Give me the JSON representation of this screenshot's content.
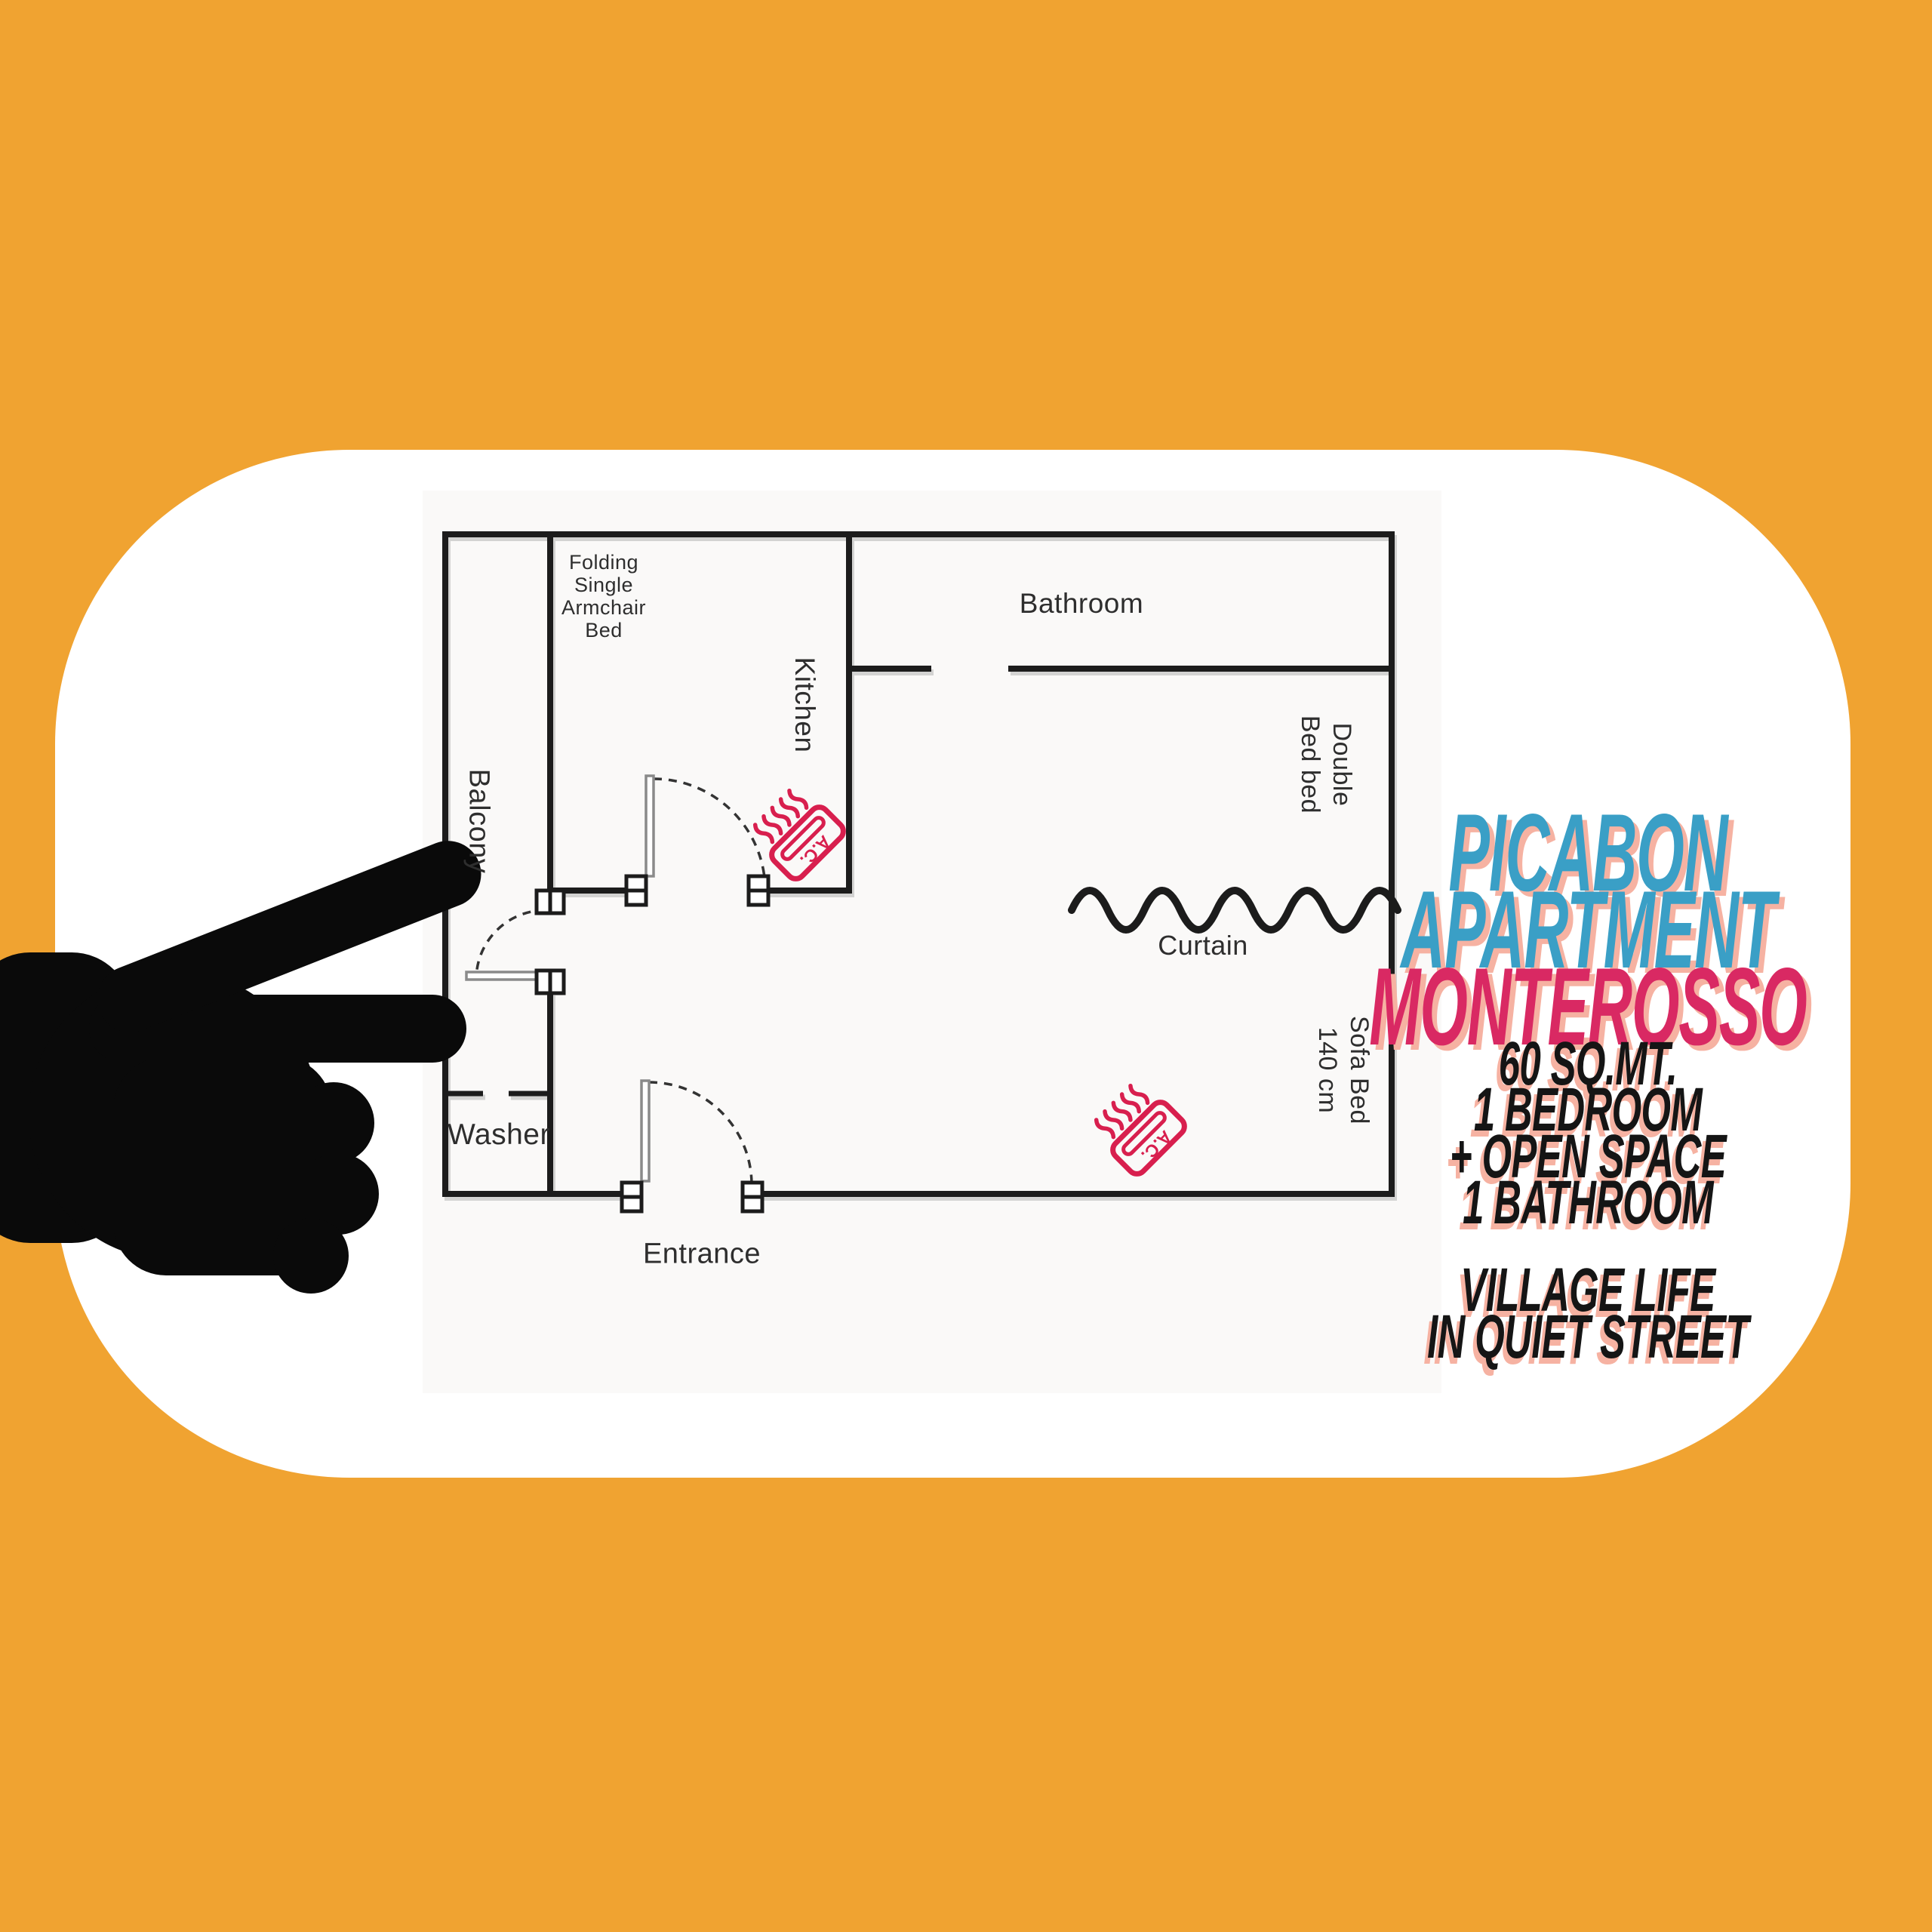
{
  "colors": {
    "background": "#F0A331",
    "card": "#FFFFFF",
    "wall": "#1C1C1C",
    "door_leaf": "#8A8A8A",
    "ac_accent": "#D81F4E",
    "hand": "#0A0A0A",
    "title_blue": "#3A9FC6",
    "title_pink": "#D92963",
    "shadow_salmon": "#F6B2A2",
    "feature_text": "#151515",
    "plan_text": "#2E2E2E"
  },
  "floorplan": {
    "labels": {
      "balcony": "Balcony",
      "kitchen": "Kitchen",
      "bathroom": "Bathroom",
      "washer": "Washer",
      "entrance": "Entrance",
      "curtain": "Curtain",
      "ac": "A.C.",
      "folding_bed_lines": [
        "Folding",
        "Single",
        "Armchair",
        "Bed"
      ],
      "double_bed_lines": [
        "Double",
        "Bed bed"
      ],
      "sofa_bed_lines": [
        "Sofa Bed",
        "140 cm"
      ]
    }
  },
  "info_panel": {
    "title_lines": [
      "PICABON",
      "APARTMENT",
      "MONTEROSSO"
    ],
    "features": [
      "60 SQ.MT.",
      "1 BEDROOM",
      "+ OPEN SPACE",
      "1 BATHROOM"
    ],
    "tagline_lines": [
      "VILLAGE LIFE",
      "IN QUIET STREET"
    ]
  }
}
